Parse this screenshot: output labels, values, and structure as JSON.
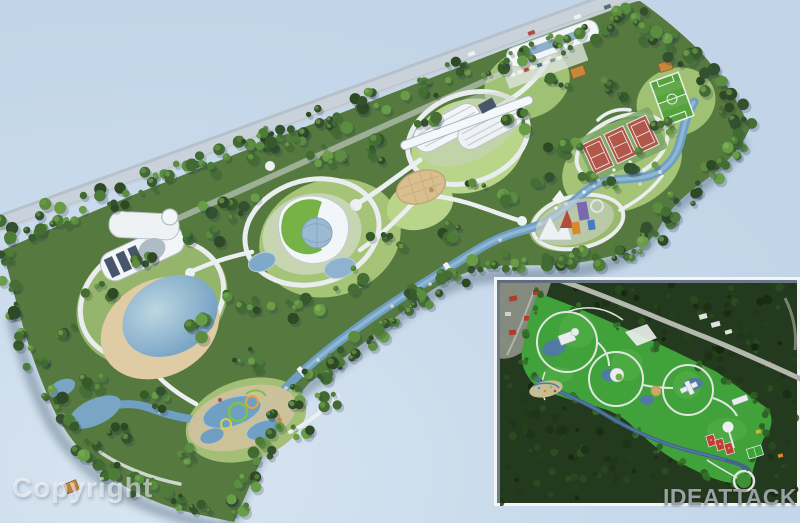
{
  "watermark": {
    "text": "Copyright"
  },
  "logo": {
    "text": "IDEATTACK"
  },
  "palette": {
    "bg": "#c8daeb",
    "road": "#b6c1cc",
    "roadLight": "#c9d2da",
    "parkBase": "#55793e",
    "lawn": "#a6c478",
    "lawnBright": "#b9d589",
    "river": "#6f9fc3",
    "riverLight": "#9ec2d8",
    "sand": "#d9bf8e",
    "beachSand": "#dfcba4",
    "building": "#f3f6f8",
    "buildingShade": "#aebcc6",
    "glassDark": "#47566b",
    "glassBlue": "#9cbad2",
    "tennis": "#b1584a",
    "pitch": "#56a23d",
    "ridePurple": "#7a68b0",
    "rideRed": "#b34a3a",
    "rideOrange": "#d9882e",
    "insetForest": "#243a1e",
    "insetPark": "#41a23c",
    "insetPath": "#e9ece9",
    "insetWater": "#41658c",
    "insetRed": "#b23b30",
    "insetRoad": "#b4b8ae",
    "clearing": "#90948a",
    "logoGray": "#9aa0a5",
    "watermark": "rgba(255,255,255,0.55)"
  },
  "scene": {
    "main_view": "3D aerial rendering of a waterfront theme-park masterplan",
    "features": [
      "coastal road",
      "entrance building with parking",
      "spaceship-style pavilion",
      "organic pavilion with glass dome",
      "lakeside pavilion",
      "beach lagoon",
      "circular sand plaza",
      "winding river",
      "three tennis courts",
      "soccer field",
      "water playground with slides",
      "amusement ride cluster",
      "perimeter forest",
      "orange-roofed service houses"
    ],
    "inset": {
      "type": "satellite overview of the same park",
      "features": [
        "surrounding forest",
        "access road",
        "park with looped white paths",
        "stream",
        "tennis courts",
        "soccer field",
        "red-roofed neighborhood"
      ]
    }
  }
}
